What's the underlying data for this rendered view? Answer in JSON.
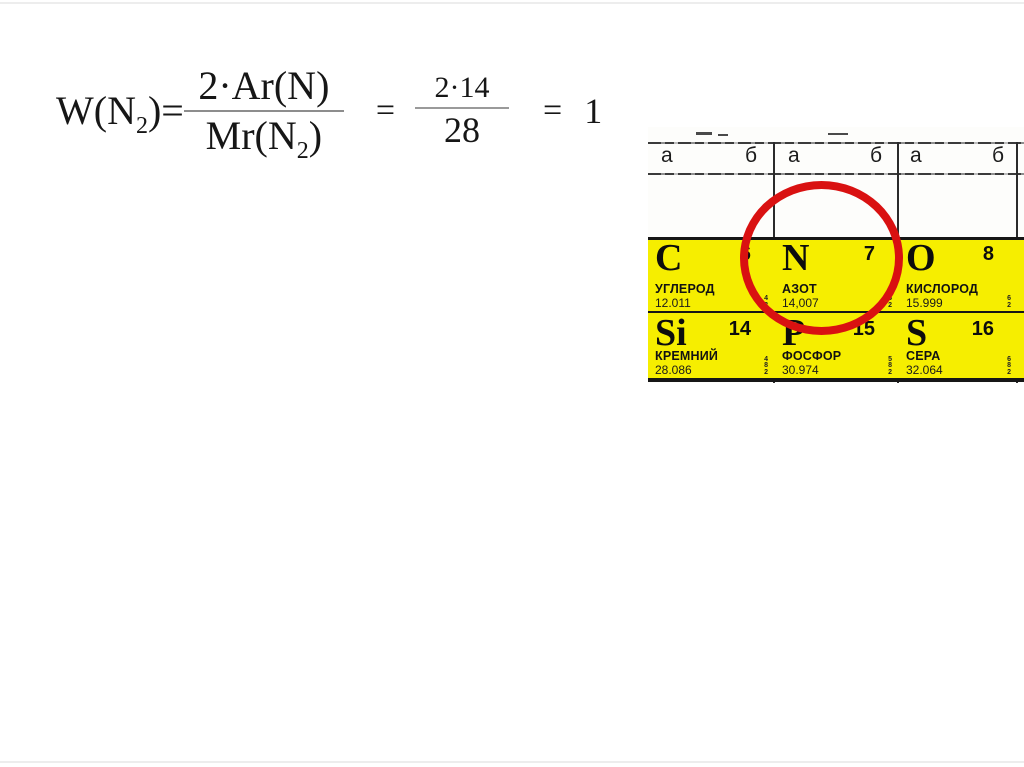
{
  "slide": {
    "background": "#ffffff",
    "edge_line_color": "#ededed"
  },
  "formula": {
    "lhs_pre": "W(N",
    "lhs_sub": "2",
    "lhs_post": ")=",
    "frac1": {
      "numerator": "2·Ar(N)",
      "den_pre": "Mr(N",
      "den_sub": "2",
      "den_post": ")"
    },
    "equals1": "=",
    "frac2": {
      "numerator": "2·14",
      "denominator": "28"
    },
    "equals2": "=",
    "result": "1"
  },
  "periodic_table": {
    "group_headers": [
      "а",
      "б",
      "а",
      "б",
      "а",
      "б"
    ],
    "cell_color": "#f6ee00",
    "highlight_color": "#d91111",
    "highlighted_element": "N",
    "elements": [
      {
        "symbol": "C",
        "number": "6",
        "name": "УГЛЕРОД",
        "mass": "12.011",
        "shells": [
          "4",
          "2"
        ]
      },
      {
        "symbol": "N",
        "number": "7",
        "name": "АЗОТ",
        "mass": "14,007",
        "shells": [
          "5",
          "2"
        ]
      },
      {
        "symbol": "O",
        "number": "8",
        "name": "КИСЛОРОД",
        "mass": "15.999",
        "shells": [
          "6",
          "2"
        ]
      },
      {
        "symbol": "Si",
        "number": "14",
        "name": "КРЕМНИЙ",
        "mass": "28.086",
        "shells": [
          "4",
          "8",
          "2"
        ]
      },
      {
        "symbol": "P",
        "number": "15",
        "name": "ФОСФОР",
        "mass": "30.974",
        "shells": [
          "5",
          "8",
          "2"
        ]
      },
      {
        "symbol": "S",
        "number": "16",
        "name": "СЕРА",
        "mass": "32.064",
        "shells": [
          "6",
          "8",
          "2"
        ]
      }
    ]
  }
}
